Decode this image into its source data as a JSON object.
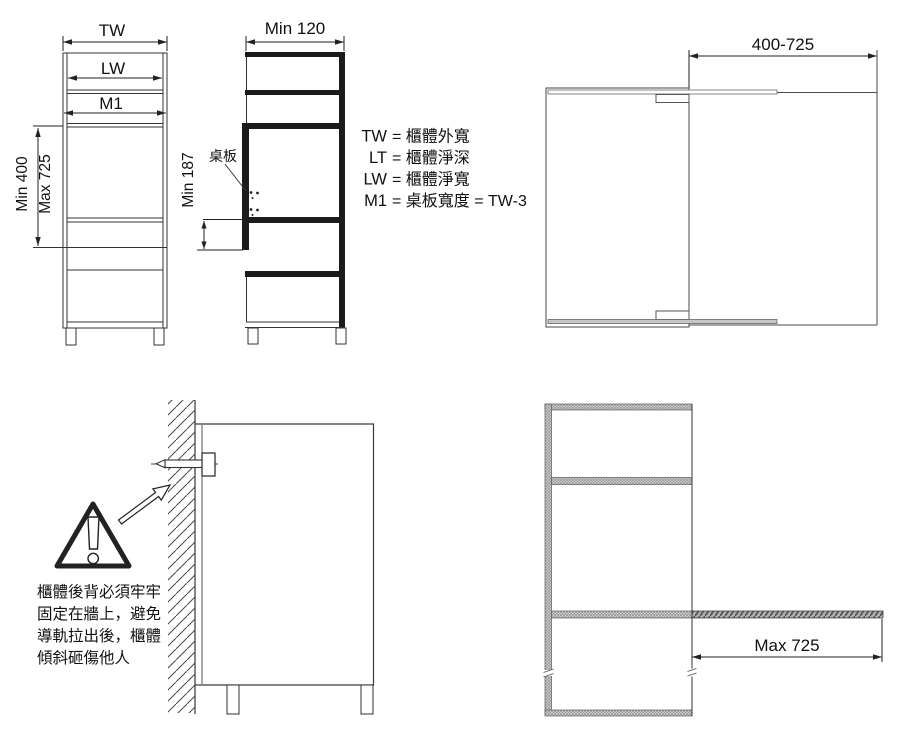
{
  "front_view": {
    "dim_width_outer": "TW",
    "dim_width_clear": "LW",
    "dim_board_width": "M1",
    "dim_height_min": "Min 400",
    "dim_height_max": "Max 725"
  },
  "side_view": {
    "dim_depth": "Min 120",
    "dim_clearance": "Min 187",
    "board_label": "桌板"
  },
  "legend": {
    "lines": [
      {
        "code": "TW",
        "rest": "= 櫃體外寬"
      },
      {
        "code": "LT",
        "rest": "= 櫃體淨深"
      },
      {
        "code": "LW",
        "rest": "= 櫃體淨寬"
      },
      {
        "code": "M1",
        "rest": "= 桌板寬度 = TW-3"
      }
    ]
  },
  "plan_view": {
    "dim_extension": "400-725"
  },
  "wall_fixing": {
    "warning_lines": [
      "櫃體後背必須牢牢",
      "固定在牆上，避免",
      "導軌拉出後，櫃體",
      "傾斜砸傷他人"
    ]
  },
  "extended_view": {
    "dim_extension": "Max 725"
  },
  "colors": {
    "line": "#333333",
    "thick_line": "#1b1b1b",
    "hatch": "#4a4a4a",
    "mesh_fill": "#dcdcdc",
    "rail_fill": "#c6c6c6"
  }
}
